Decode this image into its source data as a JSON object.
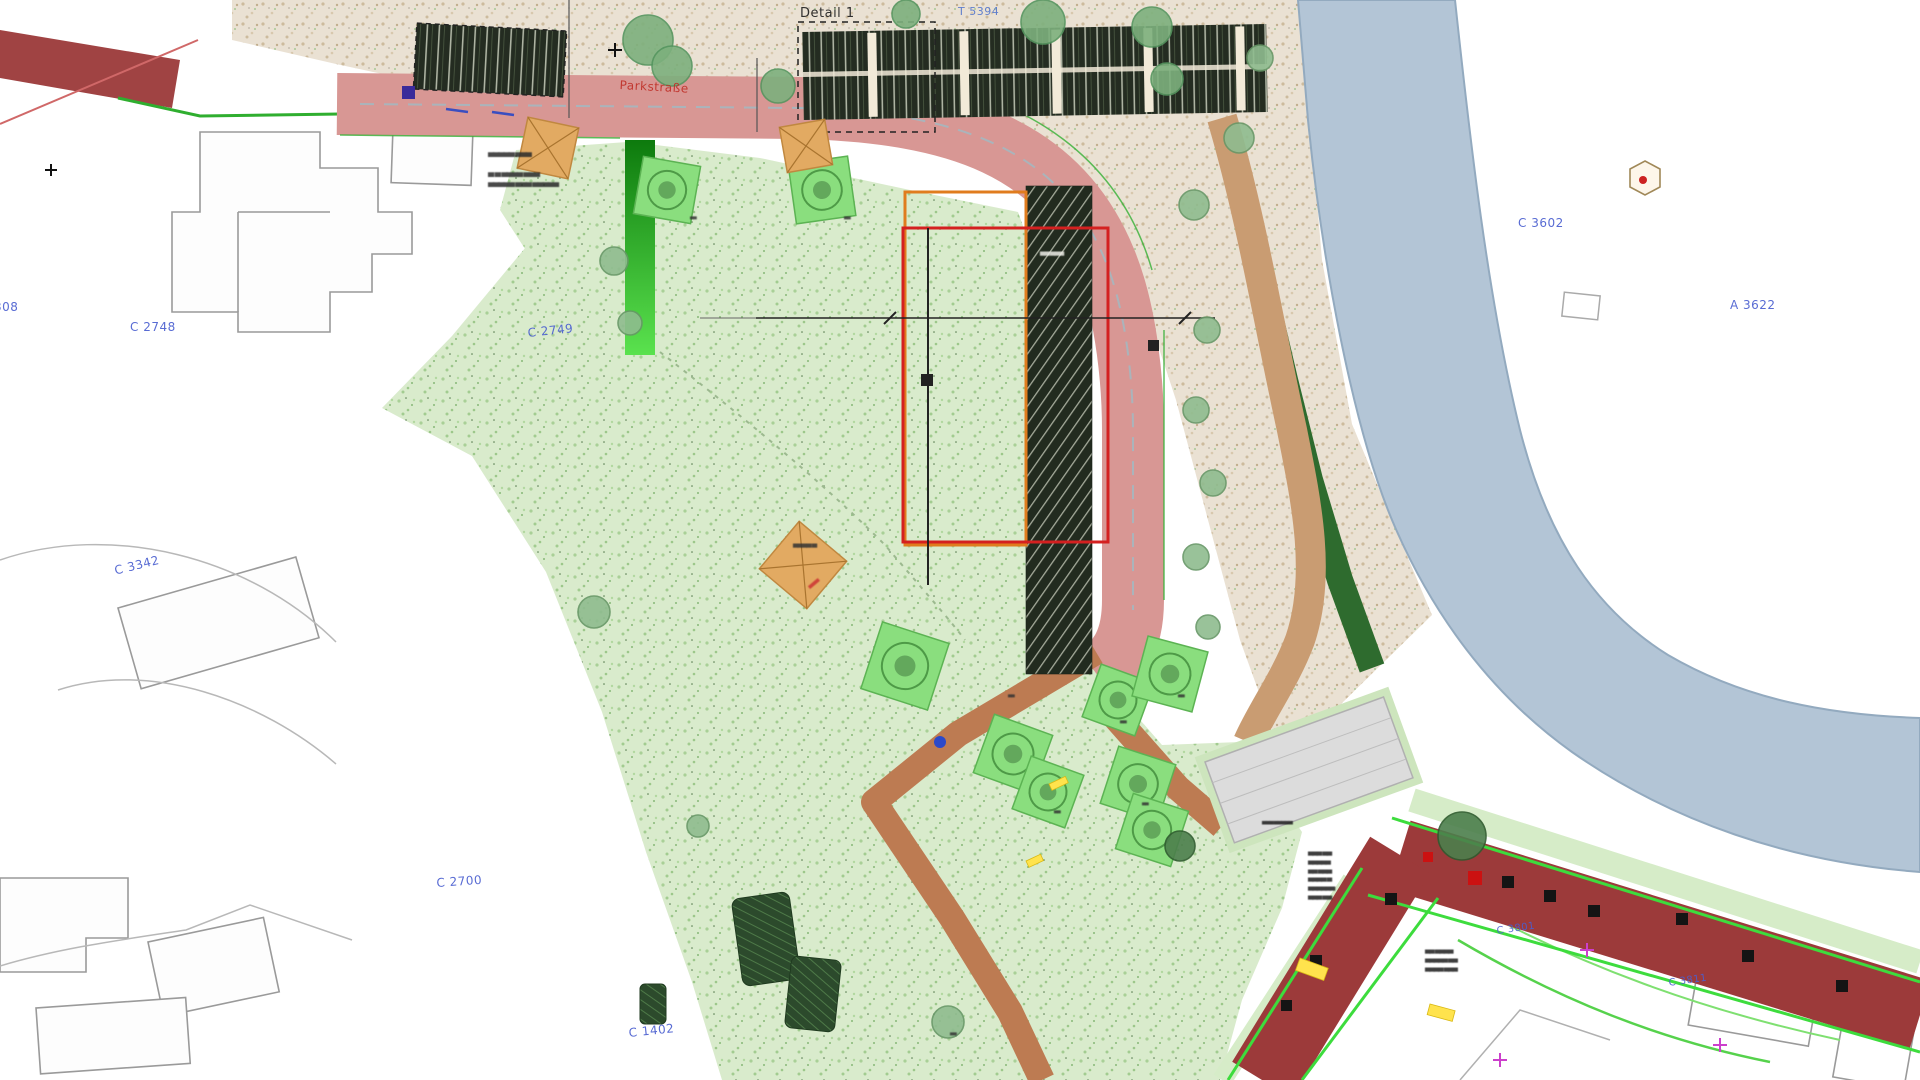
{
  "document": {
    "kind": "landscape-site-plan-drawing",
    "view": "top-down plan with cadastral map, park, roads and waterway"
  },
  "colors": {
    "water": "#b3c5d6",
    "water_edge": "#93aabf",
    "road_pink": "#d89794",
    "road_dark_red": "#a04343",
    "road_bottom_red": "#9c3a3a",
    "plaza_beige": "#eae1d3",
    "plaza_dot": "#cdbb9d",
    "lawn_green": "#d9ebcc",
    "lawn_dot": "#a9d097",
    "bright_green": "#57d84d",
    "hedge_green": "#2e6b2e",
    "tan_path": "#c99c72",
    "parking_dark": "#242c21",
    "label_blue": "#4a5fd0",
    "detail_red": "#d42020",
    "detail_orange": "#e07c1e",
    "yellow_mark": "#ffe34d",
    "magenta_mark": "#cc3fcc",
    "gray_parking": "#dcdcdc",
    "building_line": "#9a9a9a"
  },
  "labels": [
    {
      "id": "detail-1",
      "text": "Detail 1",
      "x": 800,
      "y": 6,
      "color": "#222222",
      "size": 13,
      "rot": 0
    },
    {
      "id": "t-5394",
      "text": "T 5394",
      "x": 958,
      "y": 5,
      "color": "#5577cc",
      "size": 11,
      "rot": 0
    },
    {
      "id": "parkstrasse",
      "text": "Parkstraße",
      "x": 620,
      "y": 78,
      "color": "#c03028",
      "size": 12,
      "rot": 3
    },
    {
      "id": "c-2748",
      "text": "C 2748",
      "x": 130,
      "y": 320,
      "color": "#4a5fd0",
      "size": 12,
      "rot": 0
    },
    {
      "id": "c-2749",
      "text": "C 2749",
      "x": 527,
      "y": 326,
      "color": "#4a5fd0",
      "size": 12,
      "rot": -6
    },
    {
      "id": "c-3342",
      "text": "C 3342",
      "x": 113,
      "y": 564,
      "color": "#4a5fd0",
      "size": 12,
      "rot": -14
    },
    {
      "id": "c-2700",
      "text": "C 2700",
      "x": 436,
      "y": 876,
      "color": "#4a5fd0",
      "size": 12,
      "rot": -4
    },
    {
      "id": "c-1402",
      "text": "C 1402",
      "x": 628,
      "y": 1026,
      "color": "#4a5fd0",
      "size": 12,
      "rot": -6
    },
    {
      "id": "c-3602",
      "text": "C 3602",
      "x": 1518,
      "y": 216,
      "color": "#4a5fd0",
      "size": 12,
      "rot": 0
    },
    {
      "id": "a-3622",
      "text": "A 3622",
      "x": 1730,
      "y": 298,
      "color": "#4a5fd0",
      "size": 12,
      "rot": 0
    },
    {
      "id": "p-308",
      "text": "308",
      "x": -6,
      "y": 300,
      "color": "#4a5fd0",
      "size": 12,
      "rot": 0
    },
    {
      "id": "c-3801",
      "text": "C 3801",
      "x": 1496,
      "y": 926,
      "color": "#4a5fd0",
      "size": 10,
      "rot": -8
    },
    {
      "id": "c-3811",
      "text": "C 3811",
      "x": 1668,
      "y": 978,
      "color": "#4a5fd0",
      "size": 10,
      "rot": -8
    }
  ],
  "annotations": [
    {
      "id": "note-upper-left",
      "x": 488,
      "y": 148,
      "color": "#2a2a2a",
      "size": 8,
      "rot": 0,
      "lines": [
        "▄▄▄▄▄ ▄▄▄",
        "",
        "▄ ▄ ▄▄▄▄ ▄▄▄",
        "▄▄▄▄▄ ▄▄▄ ▄▄▄▄▄"
      ]
    },
    {
      "id": "note-strip-top",
      "x": 1040,
      "y": 248,
      "color": "#f0f0ea",
      "size": 7,
      "rot": 0,
      "lines": [
        "▄▄ ▄▄▄"
      ]
    },
    {
      "id": "note-rect-bottom",
      "x": 793,
      "y": 540,
      "color": "#333333",
      "size": 7,
      "rot": 0,
      "lines": [
        "▄▄▄▄ ▄"
      ]
    },
    {
      "id": "note-road-junction",
      "x": 1308,
      "y": 848,
      "color": "#1c1c1c",
      "size": 7,
      "rot": 0,
      "lines": [
        "▄▄▄ ▄▄",
        "▄▄▄▄▄",
        "▄▄ ▄▄▄",
        "▄▄▄▄ ▄",
        "▄▄▄▄▄▄",
        "▄▄▄ ▄▄"
      ]
    },
    {
      "id": "note-road-lower",
      "x": 1425,
      "y": 946,
      "color": "#1c1c1c",
      "size": 7,
      "rot": 0,
      "lines": [
        "▄▄ ▄▄▄▄",
        "▄▄▄▄▄ ▄▄",
        "▄▄▄▄ ▄▄▄"
      ]
    },
    {
      "id": "note-shore",
      "x": 1262,
      "y": 818,
      "color": "#1c1c1c",
      "size": 6,
      "rot": 0,
      "lines": [
        "▄▄▄ ▄▄▄▄▄"
      ]
    },
    {
      "id": "note-diamond-red",
      "x": 806,
      "y": 584,
      "color": "#cc3333",
      "size": 6,
      "rot": -40,
      "lines": [
        "▄ ▄▄"
      ]
    },
    {
      "id": "bush-tag-1",
      "x": 690,
      "y": 214,
      "color": "#333333",
      "size": 5,
      "rot": 0,
      "lines": [
        "▄▄"
      ]
    },
    {
      "id": "bush-tag-2",
      "x": 844,
      "y": 214,
      "color": "#333333",
      "size": 5,
      "rot": 0,
      "lines": [
        "▄▄"
      ]
    },
    {
      "id": "bush-tag-3",
      "x": 1008,
      "y": 692,
      "color": "#333333",
      "size": 5,
      "rot": 0,
      "lines": [
        "▄▄"
      ]
    },
    {
      "id": "bush-tag-4",
      "x": 1120,
      "y": 718,
      "color": "#333333",
      "size": 5,
      "rot": 0,
      "lines": [
        "▄▄"
      ]
    },
    {
      "id": "bush-tag-5",
      "x": 1178,
      "y": 692,
      "color": "#333333",
      "size": 5,
      "rot": 0,
      "lines": [
        "▄▄"
      ]
    },
    {
      "id": "bush-tag-6",
      "x": 1054,
      "y": 808,
      "color": "#333333",
      "size": 5,
      "rot": 0,
      "lines": [
        "▄▄"
      ]
    },
    {
      "id": "bush-tag-7",
      "x": 1142,
      "y": 800,
      "color": "#333333",
      "size": 5,
      "rot": 0,
      "lines": [
        "▄▄"
      ]
    },
    {
      "id": "bush-tag-8",
      "x": 950,
      "y": 1030,
      "color": "#333333",
      "size": 5,
      "rot": 0,
      "lines": [
        "▄▄"
      ]
    }
  ],
  "trees": [
    {
      "x": 648,
      "y": 40,
      "r": 25,
      "v": "a"
    },
    {
      "x": 672,
      "y": 66,
      "r": 20,
      "v": "a"
    },
    {
      "x": 778,
      "y": 86,
      "r": 17,
      "v": "a"
    },
    {
      "x": 906,
      "y": 14,
      "r": 14,
      "v": "a"
    },
    {
      "x": 1043,
      "y": 22,
      "r": 22,
      "v": "a"
    },
    {
      "x": 1152,
      "y": 27,
      "r": 20,
      "v": "a"
    },
    {
      "x": 1167,
      "y": 79,
      "r": 16,
      "v": "a"
    },
    {
      "x": 1239,
      "y": 138,
      "r": 15,
      "v": "b"
    },
    {
      "x": 1260,
      "y": 58,
      "r": 13,
      "v": "b"
    },
    {
      "x": 1194,
      "y": 205,
      "r": 15,
      "v": "b"
    },
    {
      "x": 1207,
      "y": 330,
      "r": 13,
      "v": "b"
    },
    {
      "x": 1196,
      "y": 410,
      "r": 13,
      "v": "b"
    },
    {
      "x": 1213,
      "y": 483,
      "r": 13,
      "v": "b"
    },
    {
      "x": 1196,
      "y": 557,
      "r": 13,
      "v": "b"
    },
    {
      "x": 1208,
      "y": 627,
      "r": 12,
      "v": "b"
    },
    {
      "x": 614,
      "y": 261,
      "r": 14,
      "v": "b"
    },
    {
      "x": 630,
      "y": 323,
      "r": 12,
      "v": "b"
    },
    {
      "x": 594,
      "y": 612,
      "r": 16,
      "v": "b"
    },
    {
      "x": 698,
      "y": 826,
      "r": 11,
      "v": "b"
    },
    {
      "x": 948,
      "y": 1022,
      "r": 16,
      "v": "b"
    },
    {
      "x": 1180,
      "y": 846,
      "r": 15,
      "v": "c"
    },
    {
      "x": 1462,
      "y": 836,
      "r": 24,
      "v": "c"
    }
  ],
  "bush_squares": [
    {
      "x": 667,
      "y": 190,
      "s": 58,
      "rot": 10
    },
    {
      "x": 822,
      "y": 190,
      "s": 60,
      "rot": -8
    },
    {
      "x": 905,
      "y": 666,
      "s": 70,
      "rot": 18
    },
    {
      "x": 1118,
      "y": 700,
      "s": 56,
      "rot": 20
    },
    {
      "x": 1170,
      "y": 674,
      "s": 62,
      "rot": 15
    },
    {
      "x": 1013,
      "y": 754,
      "s": 62,
      "rot": 20
    },
    {
      "x": 1048,
      "y": 792,
      "s": 56,
      "rot": 20
    },
    {
      "x": 1138,
      "y": 784,
      "s": 60,
      "rot": 18
    },
    {
      "x": 1152,
      "y": 830,
      "s": 58,
      "rot": 18
    }
  ],
  "tan_squares": [
    {
      "x": 548,
      "y": 148,
      "s": 52,
      "rot": 12
    },
    {
      "x": 806,
      "y": 146,
      "s": 46,
      "rot": -10
    },
    {
      "x": 803,
      "y": 565,
      "s": 62,
      "rot": 40
    }
  ],
  "square_markers": [
    {
      "x": 1468,
      "y": 871,
      "s": 14,
      "c": "#cc1111"
    },
    {
      "x": 1423,
      "y": 852,
      "s": 10,
      "c": "#cc1111"
    },
    {
      "x": 1502,
      "y": 876,
      "s": 12,
      "c": "#141414"
    },
    {
      "x": 1544,
      "y": 890,
      "s": 12,
      "c": "#141414"
    },
    {
      "x": 1588,
      "y": 905,
      "s": 12,
      "c": "#141414"
    },
    {
      "x": 1676,
      "y": 913,
      "s": 12,
      "c": "#141414"
    },
    {
      "x": 1742,
      "y": 950,
      "s": 12,
      "c": "#141414"
    },
    {
      "x": 1836,
      "y": 980,
      "s": 12,
      "c": "#141414"
    },
    {
      "x": 1385,
      "y": 893,
      "s": 12,
      "c": "#141414"
    },
    {
      "x": 1310,
      "y": 955,
      "s": 12,
      "c": "#141414"
    },
    {
      "x": 1281,
      "y": 1000,
      "s": 11,
      "c": "#141414"
    },
    {
      "x": 402,
      "y": 86,
      "s": 13,
      "c": "#3a2a9a"
    },
    {
      "x": 921,
      "y": 374,
      "s": 12,
      "c": "#222222"
    },
    {
      "x": 1148,
      "y": 340,
      "s": 11,
      "c": "#222222"
    }
  ],
  "cross_markers": [
    {
      "x": 615,
      "y": 50,
      "s": 7,
      "c": "#111111"
    },
    {
      "x": 51,
      "y": 170,
      "s": 6,
      "c": "#111111"
    },
    {
      "x": 1587,
      "y": 950,
      "s": 7,
      "c": "#cc3fcc"
    },
    {
      "x": 1500,
      "y": 1060,
      "s": 7,
      "c": "#cc3fcc"
    },
    {
      "x": 1720,
      "y": 1045,
      "s": 7,
      "c": "#cc3fcc"
    }
  ],
  "yellow_marks": [
    {
      "x": 1300,
      "y": 958,
      "w": 30,
      "h": 13,
      "rot": 20
    },
    {
      "x": 1430,
      "y": 1004,
      "w": 26,
      "h": 11,
      "rot": 15
    },
    {
      "x": 1049,
      "y": 784,
      "w": 18,
      "h": 7,
      "rot": -25
    },
    {
      "x": 1026,
      "y": 861,
      "w": 16,
      "h": 7,
      "rot": -25
    }
  ],
  "blue_dots": [
    {
      "x": 940,
      "y": 742,
      "r": 6
    }
  ]
}
